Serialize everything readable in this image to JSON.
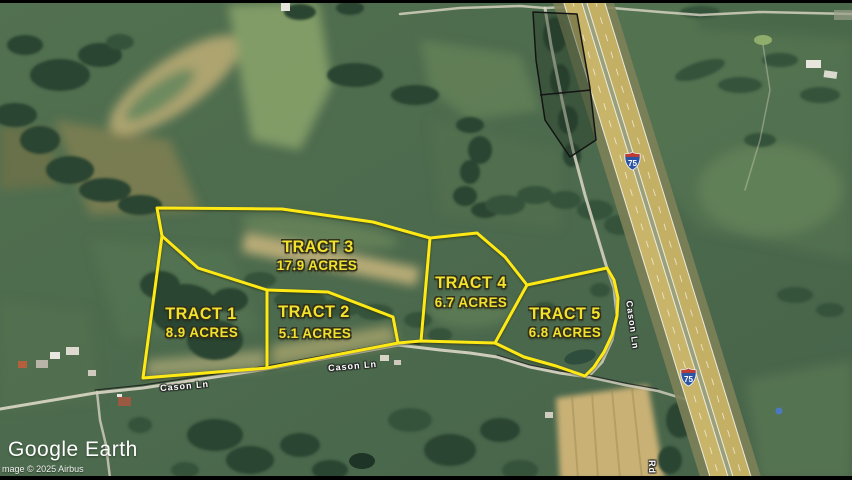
{
  "branding": {
    "logo": "Google Earth",
    "copyright": "mage © 2025 Airbus"
  },
  "tracts": [
    {
      "name": "TRACT 1",
      "acres": "8.9 ACRES"
    },
    {
      "name": "TRACT 2",
      "acres": "5.1 ACRES"
    },
    {
      "name": "TRACT 3",
      "acres": "17.9 ACRES"
    },
    {
      "name": "TRACT 4",
      "acres": "6.7 ACRES"
    },
    {
      "name": "TRACT 5",
      "acres": "6.8 ACRES"
    }
  ],
  "roads": {
    "cason_label_a": "Cason Ln",
    "cason_label_b": "Cason Ln",
    "cason_label_vertical": "Cason Ln",
    "rd_label": "Rd"
  },
  "highway": {
    "shield_number": "75"
  },
  "colors": {
    "boundary_yellow": "#ffe914",
    "label_yellow": "#f2e22e",
    "pavement_tan": "#c9b569",
    "shield_blue": "#2b55a3",
    "shield_red": "#c23b32"
  }
}
